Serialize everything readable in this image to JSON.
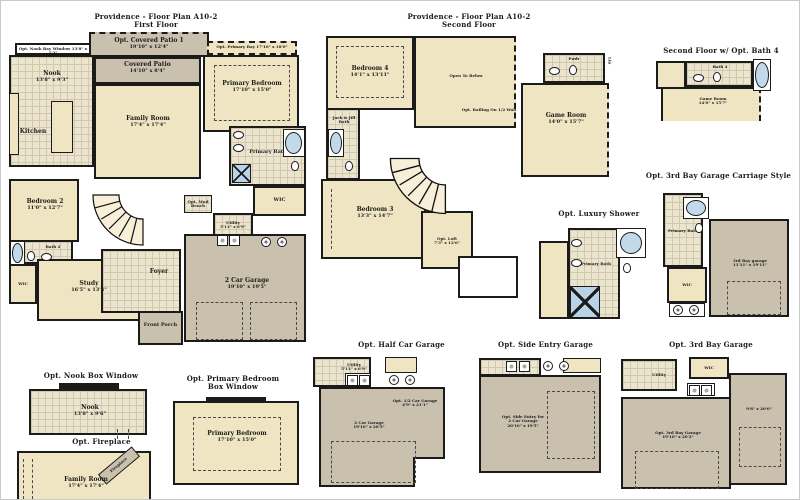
{
  "colors": {
    "tan": "#f0e5c2",
    "patio_gray": "#c9c1ae",
    "wall": "#1b1b1b",
    "fixture_blue": "#b9d3e6",
    "tile": "#ebe4ce"
  },
  "first_floor": {
    "title": "Providence - Floor Plan A10-2",
    "subtitle": "First Floor",
    "rooms": {
      "opt_covered_patio": {
        "name": "Opt. Covered Patio 1",
        "dims": "19'10\" x 12'4\""
      },
      "covered_patio": {
        "name": "Covered Patio",
        "dims": "14'10\" x 8'4\""
      },
      "opt_nook_bay": {
        "name": "Opt. Nook Bay Window 13'8\" x 1'2\""
      },
      "nook": {
        "name": "Nook",
        "dims": "13'8\" x 9'3\""
      },
      "kitchen": {
        "name": "Kitchen"
      },
      "opt_primary_bay": {
        "name": "Opt. Primary Bay 17'10\" x 18'0\""
      },
      "primary_bedroom": {
        "name": "Primary Bedroom",
        "dims": "17'10\" x 15'0\""
      },
      "family_room": {
        "name": "Family Room",
        "dims": "17'4\" x 17'4\""
      },
      "primary_bath": {
        "name": "Primary Bath"
      },
      "wic_primary": {
        "name": "WIC"
      },
      "bedroom2": {
        "name": "Bedroom 2",
        "dims": "11'0\" x 12'7\""
      },
      "bath2": {
        "name": "Bath 2"
      },
      "wic2": {
        "name": "WIC"
      },
      "study": {
        "name": "Study",
        "dims": "16'5\" x 13'4\""
      },
      "foyer": {
        "name": "Foyer"
      },
      "front_porch": {
        "name": "Front Porch"
      },
      "garage": {
        "name": "2 Car Garage",
        "dims": "19'10\" x 19'5\""
      },
      "utility": {
        "name": "Utility",
        "dims": "5'11\" x 6'9\""
      },
      "mud_bench": {
        "name": "Opt. Mud Bench"
      }
    }
  },
  "second_floor": {
    "title": "Providence - Floor Plan A10-2",
    "subtitle": "Second Floor",
    "rooms": {
      "bedroom4": {
        "name": "Bedroom 4",
        "dims": "14'1\" x 13'11\""
      },
      "open_below": {
        "name": "Open To Below"
      },
      "opt_railing": {
        "name": "Opt. Railing On 1/2 Wall"
      },
      "pwdr": {
        "name": "Pwdr"
      },
      "lin": {
        "name": "Lin"
      },
      "game_room": {
        "name": "Game Room",
        "dims": "14'0\" x 15'7\""
      },
      "jack_jill_bath": {
        "name": "Jack & Jill Bath"
      },
      "bedroom3": {
        "name": "Bedroom 3",
        "dims": "13'3\" x 14'7\""
      },
      "opt_loft": {
        "name": "Opt. Loft",
        "dims": "7'3\" x 12'6\""
      }
    }
  },
  "opt_bath4": {
    "title": "Second Floor w/ Opt. Bath 4",
    "rooms": {
      "bath4": {
        "name": "Bath 4"
      },
      "game_room": {
        "name": "Game Room",
        "dims": "14'0\" x 15'7\""
      }
    }
  },
  "opt_carriage": {
    "title": "Opt. 3rd Bay Garage Carriage Style",
    "rooms": {
      "primary_bath": {
        "name": "Primary Bath"
      },
      "wic": {
        "name": "WIC"
      },
      "garage": {
        "name": "3rd Bay garage",
        "dims": "11'11\" x 19'11\""
      }
    }
  },
  "opt_luxury_shower": {
    "title": "Opt. Luxury Shower",
    "rooms": {
      "primary_bath": {
        "name": "Primary Bath"
      }
    }
  },
  "opt_nook_box": {
    "title": "Opt. Nook Box Window",
    "rooms": {
      "nook": {
        "name": "Nook",
        "dims": "13'8\" x 9'6\""
      }
    }
  },
  "opt_fireplace": {
    "title": "Opt. Fireplace",
    "rooms": {
      "family_room": {
        "name": "Family Room",
        "dims": "17'4\" x 17'4\""
      },
      "fireplace": {
        "name": "Fireplace"
      }
    }
  },
  "opt_primary_box": {
    "title": "Opt. Primary Bedroom",
    "title2": "Box Window",
    "rooms": {
      "primary_bedroom": {
        "name": "Primary Bedroom",
        "dims": "17'10\" x 15'0\""
      }
    }
  },
  "opt_half_garage": {
    "title": "Opt. Half Car Garage",
    "rooms": {
      "utility": {
        "name": "Utility",
        "dims": "5'11\" x 6'9\""
      },
      "garage": {
        "name": "2 Car Garage",
        "dims": "19'10\" x 20'5\""
      },
      "half": {
        "name": "Opt. 1/2 Car Garage",
        "dims": "4'9\" x 21'1\""
      }
    }
  },
  "opt_side_entry": {
    "title": "Opt. Side Entry Garage",
    "rooms": {
      "garage": {
        "name": "Opt. Side Entry for",
        "name2": "2 Car Garage",
        "dims": "20'10\" x 19'5\""
      }
    }
  },
  "opt_3rd_bay": {
    "title": "Opt. 3rd Bay Garage",
    "rooms": {
      "wic": {
        "name": "WIC"
      },
      "utility": {
        "name": "Utility"
      },
      "garage": {
        "name": "Opt. 3rd Bay Garage",
        "dims": "19'10\" x 20'2\""
      },
      "bay": {
        "dims": "9'8\" x 20'0\""
      }
    }
  }
}
